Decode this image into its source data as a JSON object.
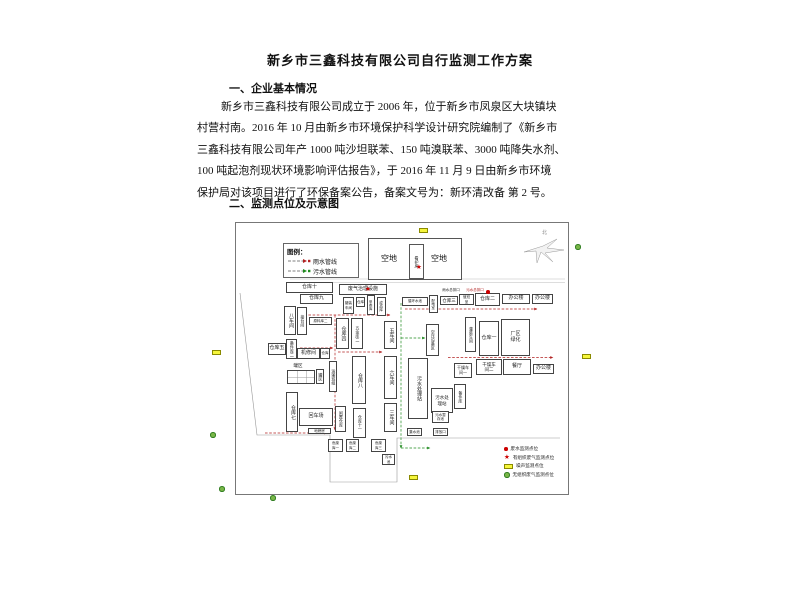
{
  "doc": {
    "title": "新乡市三鑫科技有限公司自行监测工作方案",
    "heading1": "一、企业基本情况",
    "para_lines": [
      "新乡市三鑫科技有限公司成立于 2006 年，位于新乡市凤泉区大块镇块",
      "村营村南。2016 年 10 月由新乡市环境保护科学设计研究院编制了《新乡市",
      "三鑫科技有限公司年产 1000 吨沙坦联苯、150 吨溴联苯、3000 吨降失水剂、",
      "100 吨起泡剂现状环境影响评估报告》，于 2016 年 11 月 9 日由新乡市环境",
      "保护局对该项目进行了环保备案公告，备案文号为：新环清改备 第 2 号。"
    ],
    "heading2": "二、监测点位及示意图"
  },
  "diagram": {
    "legend": {
      "title": "图例：",
      "rain_label": "雨水管线",
      "sewage_label": "污水管线"
    },
    "north_label": "北",
    "open_left": "空地",
    "open_right": "空地",
    "guard": "看护房",
    "colors": {
      "rain": "#b22222",
      "sewage": "#1e8a1e",
      "marker_red": "#cc0000",
      "noise_fill": "#f6f63c",
      "noise_border": "#8a8a00",
      "gas_fill": "#7ab648",
      "gas_border": "#2f7d1f"
    },
    "point_legend": [
      {
        "sym": "dot",
        "label": "废水监测点位"
      },
      {
        "sym": "star",
        "label": "有组织废气监测点位"
      },
      {
        "sym": "noise",
        "label": "噪声监测点位"
      },
      {
        "sym": "gas",
        "label": "无组织废气监测点位"
      }
    ],
    "buildings": [
      {
        "label": "仓库十",
        "x": 81,
        "y": 64,
        "w": 47,
        "h": 11
      },
      {
        "label": "仓库九",
        "x": 95,
        "y": 76,
        "w": 33,
        "h": 10
      },
      {
        "label": "八车间",
        "x": 79,
        "y": 88,
        "w": 12,
        "h": 29,
        "v": 1
      },
      {
        "label": "接台间",
        "x": 92,
        "y": 89,
        "w": 10,
        "h": 28,
        "v": 1,
        "fs": 4
      },
      {
        "label": "原料库二",
        "x": 104,
        "y": 99,
        "w": 23,
        "h": 8,
        "fs": 3.5
      },
      {
        "label": "仓库五",
        "x": 63,
        "y": 125,
        "w": 18,
        "h": 12
      },
      {
        "label": "备件库二",
        "x": 81,
        "y": 121,
        "w": 11,
        "h": 20,
        "v": 1,
        "fs": 4
      },
      {
        "label": "机修间",
        "x": 92,
        "y": 130,
        "w": 23,
        "h": 11
      },
      {
        "label": "仓库",
        "x": 115,
        "y": 130,
        "w": 10,
        "h": 11,
        "fs": 3.5
      },
      {
        "label": "罐区",
        "x": 86,
        "y": 145,
        "w": 14,
        "h": 6,
        "fs": 4.5,
        "nb": 1
      },
      {
        "label": "",
        "x": 82,
        "y": 152,
        "w": 28,
        "h": 14,
        "grid": 1
      },
      {
        "label": "罐区",
        "x": 111,
        "y": 151,
        "w": 8,
        "h": 15,
        "v": 1,
        "fs": 4
      },
      {
        "label": "仓库七",
        "x": 81,
        "y": 174,
        "w": 12,
        "h": 40,
        "v": 1
      },
      {
        "label": "回车场",
        "x": 94,
        "y": 190,
        "w": 34,
        "h": 18
      },
      {
        "label": "地磅房",
        "x": 103,
        "y": 210,
        "w": 23,
        "h": 6,
        "fs": 3.5
      },
      {
        "label": "运输班组",
        "x": 124,
        "y": 143,
        "w": 8,
        "h": 31,
        "v": 1,
        "fs": 4
      },
      {
        "label": "废气治理设施",
        "x": 134,
        "y": 66,
        "w": 48,
        "h": 11
      },
      {
        "label": "罐装\n车间",
        "x": 138,
        "y": 79,
        "w": 11,
        "h": 17,
        "fs": 3.5
      },
      {
        "label": "仓库",
        "x": 151,
        "y": 79,
        "w": 9,
        "h": 10,
        "fs": 3.5
      },
      {
        "label": "甲类库",
        "x": 162,
        "y": 77,
        "w": 8,
        "h": 20,
        "v": 1,
        "fs": 3.5
      },
      {
        "label": "成品库",
        "x": 172,
        "y": 79,
        "w": 9,
        "h": 19,
        "v": 1,
        "fs": 3.5
      },
      {
        "label": "仓库四",
        "x": 131,
        "y": 100,
        "w": 13,
        "h": 31,
        "v": 1
      },
      {
        "label": "五金库二",
        "x": 146,
        "y": 100,
        "w": 12,
        "h": 31,
        "v": 1,
        "fs": 4
      },
      {
        "label": "五车间",
        "x": 179,
        "y": 103,
        "w": 13,
        "h": 28,
        "v": 1
      },
      {
        "label": "仓库八",
        "x": 147,
        "y": 138,
        "w": 14,
        "h": 48,
        "v": 1
      },
      {
        "label": "六车间",
        "x": 179,
        "y": 138,
        "w": 13,
        "h": 43,
        "v": 1
      },
      {
        "label": "三车间",
        "x": 179,
        "y": 185,
        "w": 13,
        "h": 29,
        "v": 1
      },
      {
        "label": "闲置仓库",
        "x": 130,
        "y": 188,
        "w": 11,
        "h": 26,
        "v": 1,
        "fs": 4
      },
      {
        "label": "仓库十一",
        "x": 148,
        "y": 190,
        "w": 13,
        "h": 30,
        "v": 1,
        "fs": 4
      },
      {
        "label": "危废\n库一",
        "x": 123,
        "y": 221,
        "w": 15,
        "h": 13,
        "fs": 3.5
      },
      {
        "label": "危废\n库二",
        "x": 141,
        "y": 221,
        "w": 13,
        "h": 13,
        "fs": 3.5
      },
      {
        "label": "危废\n库三",
        "x": 166,
        "y": 221,
        "w": 15,
        "h": 13,
        "fs": 3.5
      },
      {
        "label": "污水\n池",
        "x": 177,
        "y": 236,
        "w": 13,
        "h": 11,
        "fs": 3.5
      },
      {
        "label": "污水处理站",
        "x": 203,
        "y": 140,
        "w": 20,
        "h": 61,
        "v": 1
      },
      {
        "label": "空压设备区",
        "x": 221,
        "y": 106,
        "w": 13,
        "h": 32,
        "v": 1,
        "fs": 4
      },
      {
        "label": "循环水池",
        "x": 197,
        "y": 79,
        "w": 26,
        "h": 9,
        "fs": 3.5
      },
      {
        "label": "配电室",
        "x": 224,
        "y": 77,
        "w": 9,
        "h": 18,
        "v": 1,
        "fs": 3.5
      },
      {
        "label": "仓库三",
        "x": 235,
        "y": 78,
        "w": 18,
        "h": 9,
        "fs": 4.5
      },
      {
        "label": "值班\n室",
        "x": 254,
        "y": 76,
        "w": 15,
        "h": 11,
        "fs": 3.5
      },
      {
        "label": "仓库二",
        "x": 270,
        "y": 75,
        "w": 25,
        "h": 13
      },
      {
        "label": "办公楼",
        "x": 297,
        "y": 76,
        "w": 28,
        "h": 10
      },
      {
        "label": "办公楼",
        "x": 327,
        "y": 76,
        "w": 21,
        "h": 10
      },
      {
        "label": "灌装车间",
        "x": 260,
        "y": 99,
        "w": 11,
        "h": 35,
        "v": 1,
        "fs": 4
      },
      {
        "label": "仓库一",
        "x": 274,
        "y": 103,
        "w": 20,
        "h": 35
      },
      {
        "label": "厂区\n绿化",
        "x": 296,
        "y": 101,
        "w": 29,
        "h": 37
      },
      {
        "label": "干燥车\n间一",
        "x": 249,
        "y": 145,
        "w": 18,
        "h": 15,
        "fs": 4
      },
      {
        "label": "干燥车\n间二",
        "x": 271,
        "y": 141,
        "w": 26,
        "h": 16,
        "fs": 4.5
      },
      {
        "label": "餐厅",
        "x": 298,
        "y": 141,
        "w": 28,
        "h": 16
      },
      {
        "label": "办公楼",
        "x": 328,
        "y": 146,
        "w": 21,
        "h": 10
      },
      {
        "label": "污水处\n理站",
        "x": 226,
        "y": 170,
        "w": 22,
        "h": 25,
        "fs": 4.5
      },
      {
        "label": "备件库",
        "x": 249,
        "y": 166,
        "w": 12,
        "h": 25,
        "v": 1,
        "fs": 4
      },
      {
        "label": "污水暂\n存池",
        "x": 227,
        "y": 193,
        "w": 17,
        "h": 12,
        "fs": 3.5
      },
      {
        "label": "排放口",
        "x": 228,
        "y": 210,
        "w": 15,
        "h": 8,
        "fs": 3.5
      },
      {
        "label": "集水池",
        "x": 202,
        "y": 210,
        "w": 15,
        "h": 8,
        "fs": 3.5
      },
      {
        "label": "雨水总排口",
        "x": 234,
        "y": 70,
        "w": 24,
        "h": 5,
        "fs": 3.5,
        "nb": 1
      },
      {
        "label": "污水总排口",
        "x": 260,
        "y": 70,
        "w": 20,
        "h": 5,
        "fs": 3.5,
        "nb": 1,
        "red": 1
      }
    ],
    "markers": [
      {
        "t": "star",
        "x": 160,
        "y": 68
      },
      {
        "t": "star",
        "x": 211,
        "y": 46
      },
      {
        "t": "dot",
        "x": 281,
        "y": 72
      },
      {
        "t": "noise",
        "x": 214,
        "y": 10
      },
      {
        "t": "noise",
        "x": 7,
        "y": 132
      },
      {
        "t": "noise",
        "x": 377,
        "y": 136
      },
      {
        "t": "noise",
        "x": 204,
        "y": 257
      },
      {
        "t": "gas",
        "x": 370,
        "y": 26
      },
      {
        "t": "gas",
        "x": 5,
        "y": 214
      },
      {
        "t": "gas",
        "x": 14,
        "y": 268
      },
      {
        "t": "gas",
        "x": 65,
        "y": 277
      }
    ],
    "pipes": {
      "rain": [
        [
          95,
          97,
          185,
          97
        ],
        [
          200,
          91,
          332,
          91
        ],
        [
          130,
          97,
          130,
          212
        ],
        [
          95,
          130,
          128,
          130
        ],
        [
          133,
          134,
          177,
          134
        ],
        [
          60,
          215,
          122,
          215
        ],
        [
          243,
          139.5,
          348,
          139.5
        ]
      ],
      "sewage": [
        [
          196,
          85,
          196,
          230
        ],
        [
          209,
          140,
          209,
          200
        ],
        [
          196,
          120,
          220,
          120
        ],
        [
          196,
          230,
          225,
          230
        ]
      ]
    }
  }
}
